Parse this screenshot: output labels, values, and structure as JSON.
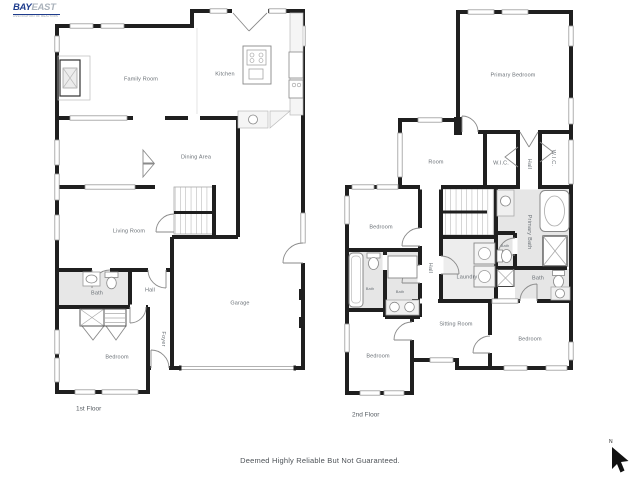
{
  "logo": {
    "bay": "BAY",
    "east": "EAST",
    "tagline": "ASSOCIATION OF REALTORS"
  },
  "floor1": {
    "floor_label": "1st Floor",
    "rooms": {
      "family_room": "Family Room",
      "kitchen": "Kitchen",
      "dining_area": "Dining Area",
      "living_room": "Living Room",
      "bath": "Bath",
      "hall": "Hall",
      "garage": "Garage",
      "foyer": "Foyer",
      "bedroom": "Bedroom"
    }
  },
  "floor2": {
    "floor_label": "2nd Floor",
    "rooms": {
      "primary_bedroom": "Primary Bedroom",
      "room": "Room",
      "wic_left": "W.I.C.",
      "wic_right": "W.I.C.",
      "hall_upper": "Hall",
      "primary_bath": "Primary Bath",
      "bath_wc": "Bath",
      "bedroom_mid": "Bedroom",
      "bath_tub": "Bath",
      "bath_double": "Bath",
      "hall_lower": "Hall",
      "laundry": "Laundry",
      "bath_right": "Bath",
      "sitting_room": "Sitting Room",
      "bedroom_bottom_left": "Bedroom",
      "bedroom_bottom_right": "Bedroom"
    }
  },
  "footer": {
    "disclaimer": "Deemed Highly Reliable But Not Guaranteed."
  },
  "compass": {
    "north_label": "N"
  }
}
